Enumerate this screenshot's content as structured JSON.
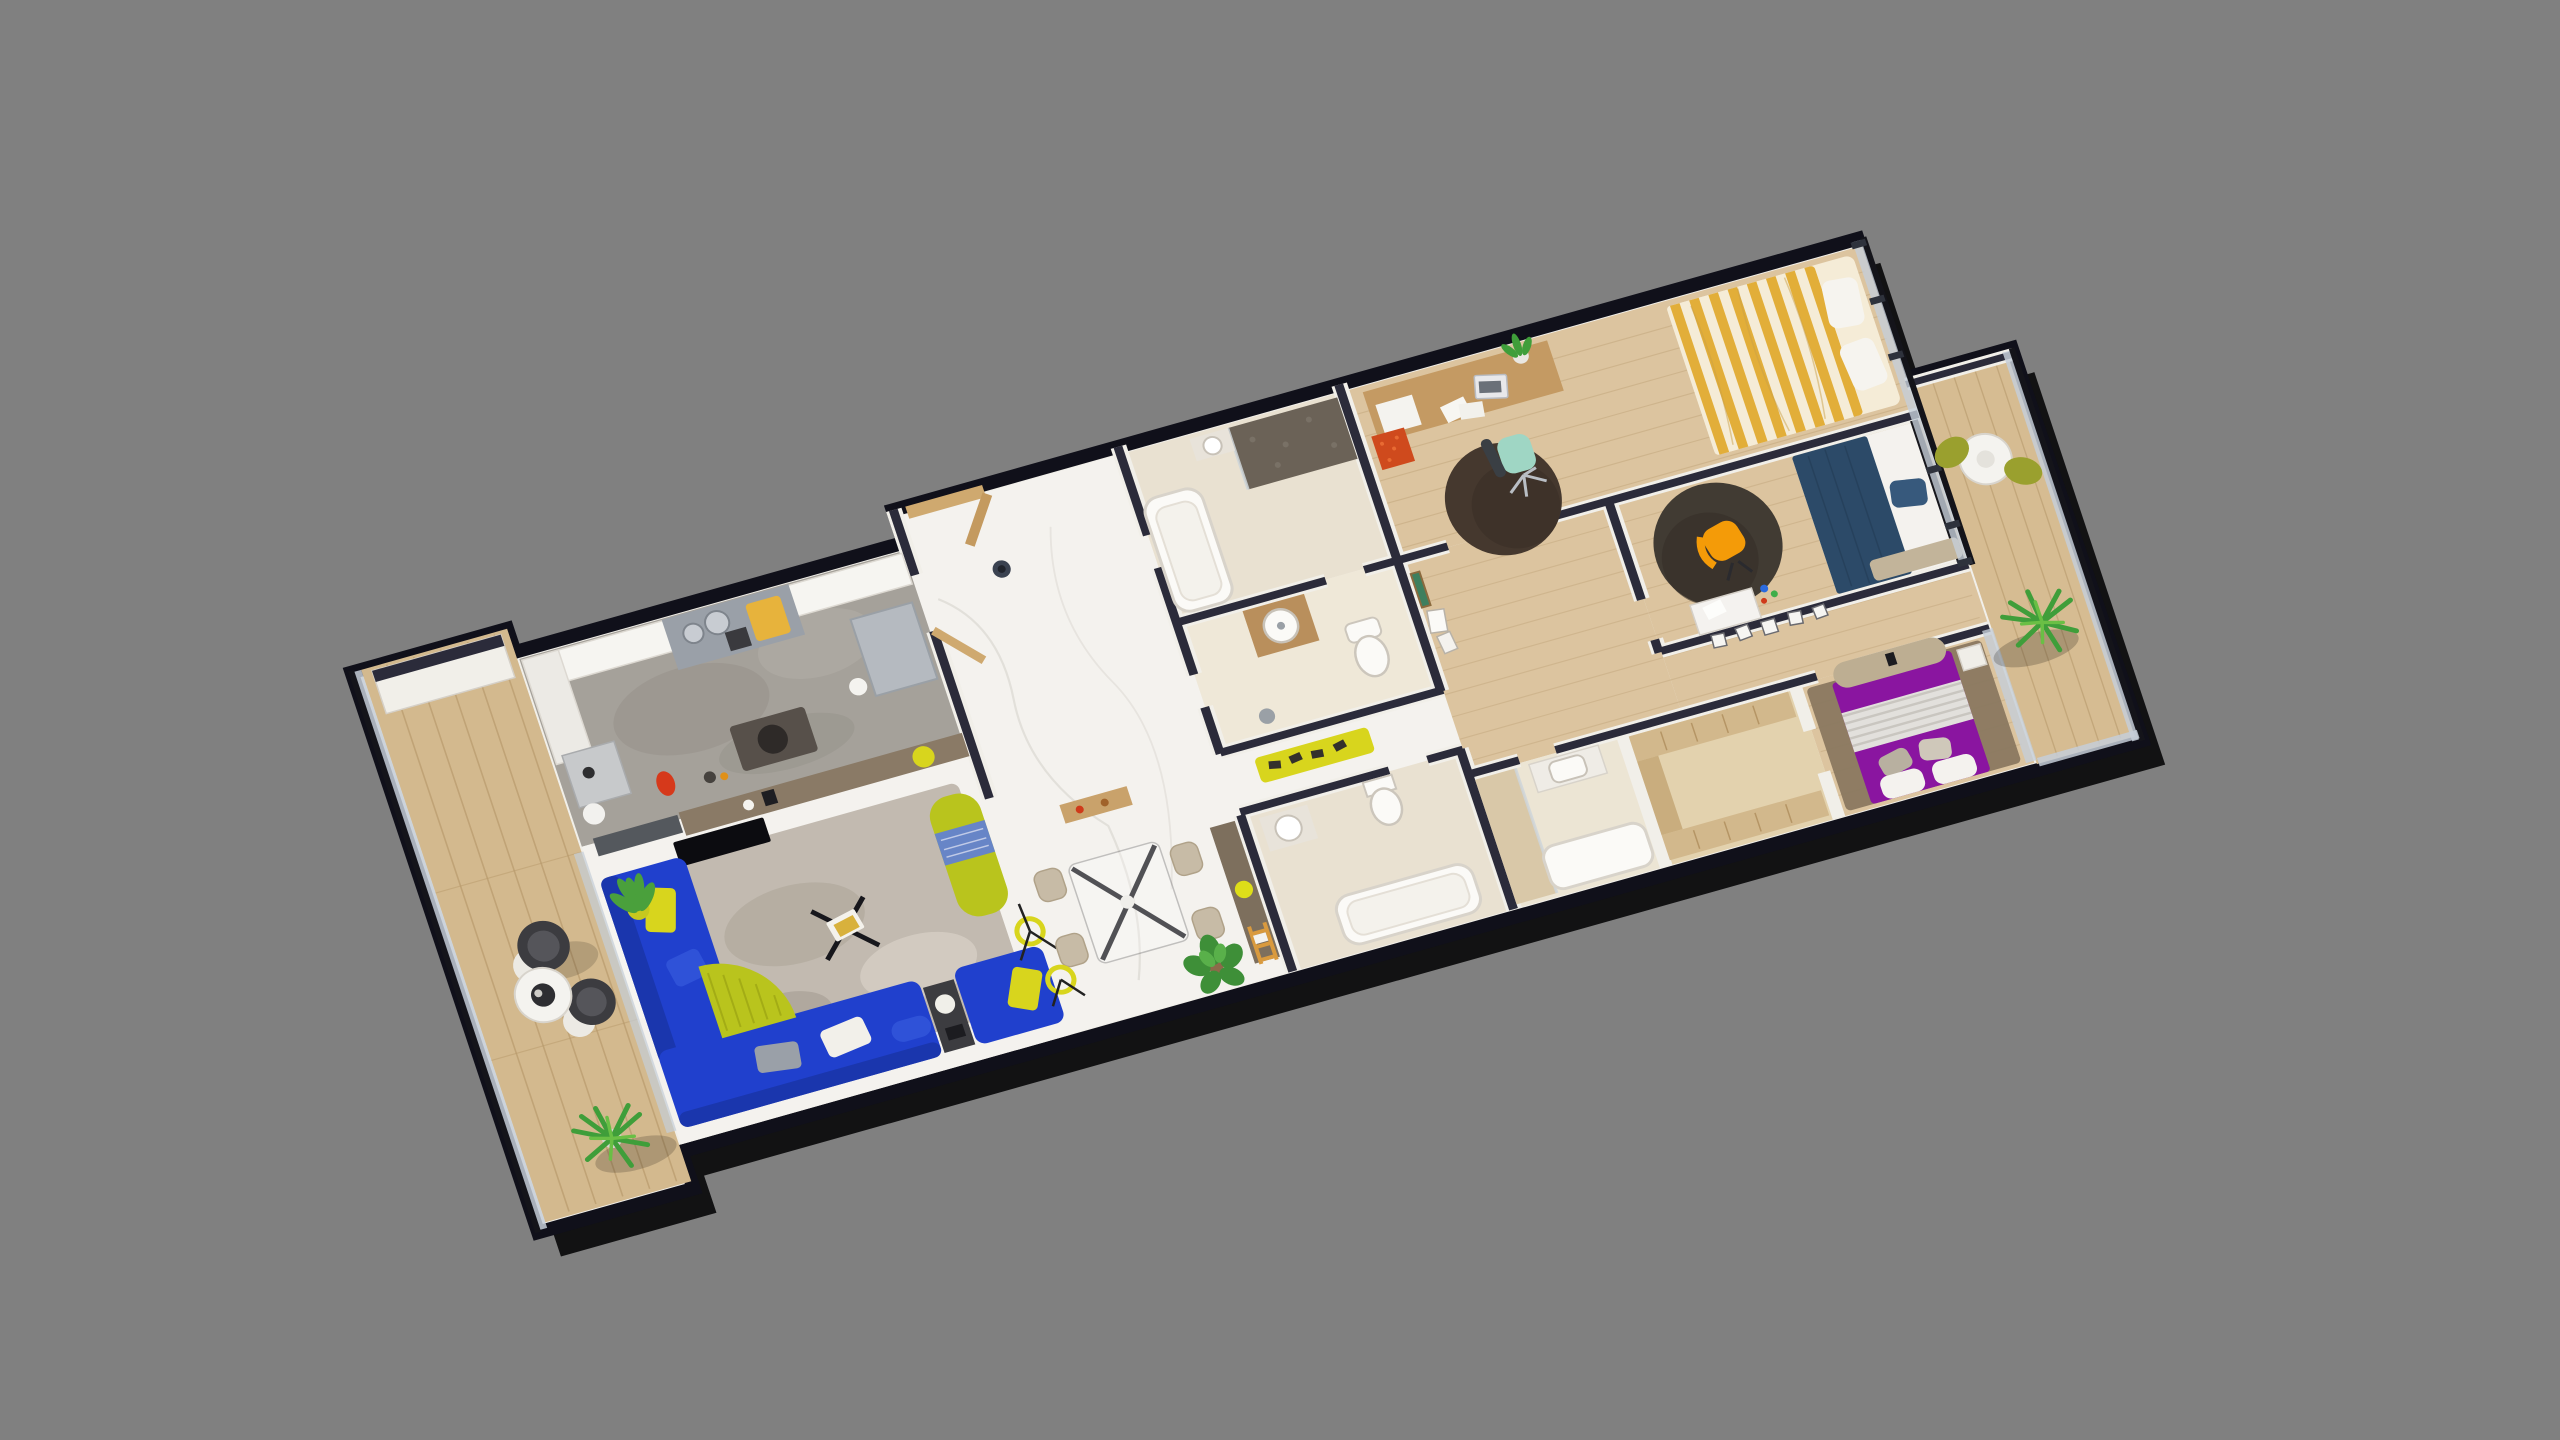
{
  "scene": {
    "type": "3d-floorplan-isometric-render",
    "view_rotation_deg": -16,
    "no_visible_text": true
  },
  "colors": {
    "background": "#808080",
    "shadow_black": "#050507",
    "exterior_cap": "#10101a",
    "interior_cap": "#2b2b3a",
    "wall_white": "#f1efe9",
    "marble_floor": "#f4f2ee",
    "marble_vein": "#d9d5cf",
    "wood_floor": "#dcc49f",
    "wood_line": "#c3a87e",
    "terrace_deck": "#d3b98e",
    "balcony_deck": "#d6bc92",
    "kitchen_floor": "#a5a19a",
    "bath_floor": "#e9e1d1",
    "ensuite_floor": "#ece5d4",
    "walkin_floor": "#e3d2ae",
    "sofa_blue": "#2040cd",
    "sofa_blue_dark": "#1a36ad",
    "accent_chartreuse": "#b9c41d",
    "accent_yellow": "#d8d51d",
    "bed_yellow_stripe": "#e2ae39",
    "bed_yellow_base": "#f5ecd7",
    "bed_navy": "#2c4a68",
    "pillow_navy": "#37597c",
    "bed_purple": "#8a15a0",
    "blanket_gray": "#e2e0dc",
    "rug_dark": "#45382e",
    "rug_dark2": "#413b33",
    "rug_living": "#c2bab0",
    "master_rug": "#8a7860",
    "chair_beige": "#c7bba6",
    "chair_orange": "#f49b08",
    "chair_mint": "#9fd6c4",
    "balcony_chair_olive": "#9aa02e",
    "terrace_chair_dark": "#3c3c40",
    "desk_wood": "#c49a63",
    "cabinet_red": "#cf4a1d",
    "console_brown": "#7d6f5d",
    "bar_counter": "#8a7a66",
    "island_gray": "#9aa0a8",
    "fridge_gray": "#b5bac0",
    "glass": "#c5ced8",
    "door_tan": "#cfa96f",
    "plant_green": "#3f9e3a",
    "plant_light": "#6abf45",
    "mosaic_dark": "#6b6257",
    "wardrobe_tan": "#d2b88c",
    "bench_beige": "#bdae92",
    "fixture_white": "#fbfaf7",
    "tv_black": "#0c0c10"
  },
  "rooms": [
    {
      "id": "terrace-left",
      "floor": "wood-deck",
      "items": [
        "bowl-chair",
        "bowl-chair",
        "round-coffee-table",
        "palm-plant",
        "white-planter",
        "glass-parapet"
      ]
    },
    {
      "id": "kitchen",
      "floor": "concrete-gray",
      "items": [
        "counter-run",
        "cooktop-island",
        "sink-bowls",
        "cutting-board",
        "fridge-cabinet",
        "small-table",
        "red-kettle",
        "floor-mat-with-pot",
        "bar-counter",
        "balloon-lamp"
      ]
    },
    {
      "id": "living-room",
      "floor": "marble",
      "items": [
        "blue-sectional-sofa",
        "blue-sofa",
        "chartreuse-throw",
        "chartreuse-chaise",
        "tv-panel",
        "area-rug",
        "coffee-table",
        "floor-lamp",
        "potted-plant",
        "side-table"
      ]
    },
    {
      "id": "entry-dining-hall",
      "floor": "marble",
      "items": [
        "entry-door",
        "pendant-dot",
        "dining-table",
        "dining-chair",
        "dining-chair",
        "dining-chair",
        "dining-chair",
        "monstera-plant",
        "ring-floor-lamp",
        "console-desk",
        "ladder-shelf",
        "yellow-shoe-bench",
        "wood-shelf"
      ]
    },
    {
      "id": "bathroom-1",
      "floor": "beige-tile",
      "items": [
        "mosaic-shower",
        "bathtub",
        "sink"
      ]
    },
    {
      "id": "wc",
      "floor": "beige-tile",
      "items": [
        "wood-vanity",
        "round-sink",
        "toilet",
        "bin"
      ]
    },
    {
      "id": "bathroom-2",
      "floor": "beige-tile",
      "items": [
        "bathtub",
        "sink",
        "toilet"
      ]
    },
    {
      "id": "bedroom-yellow",
      "floor": "wood",
      "items": [
        "striped-double-bed",
        "pillows",
        "desk",
        "laptop",
        "storage-box",
        "red-drawer-unit",
        "desk-chair",
        "round-dark-rug",
        "desk-plant"
      ]
    },
    {
      "id": "bedroom-navy",
      "floor": "wood",
      "items": [
        "navy-double-bed",
        "navy-pillow",
        "round-dark-rug",
        "orange-armchair",
        "white-desk",
        "foot-bench",
        "picture-frames"
      ]
    },
    {
      "id": "corridor",
      "floor": "wood",
      "items": [
        "leaning-frames",
        "landscape-art",
        "frame-row"
      ]
    },
    {
      "id": "master-suite",
      "floor": "wood",
      "items": [
        "purple-double-bed",
        "gray-striped-blanket",
        "pillows",
        "curved-bench",
        "brown-rug",
        "nightstand",
        "walk-in-wardrobe",
        "ensuite-shower",
        "ensuite-vanity",
        "ensuite-tub"
      ]
    },
    {
      "id": "balcony-right",
      "floor": "wood-deck",
      "items": [
        "round-table",
        "olive-chair",
        "olive-chair",
        "palm-plant",
        "glass-parapet"
      ]
    }
  ]
}
